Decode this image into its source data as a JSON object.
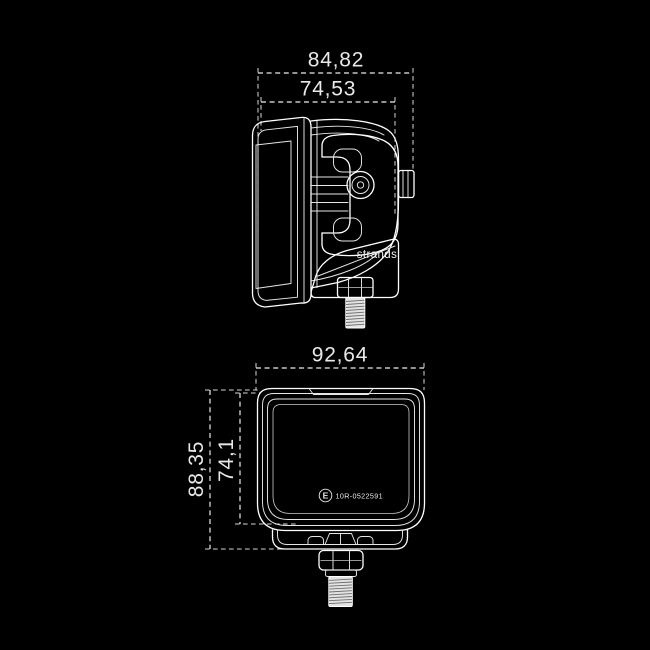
{
  "colors": {
    "background": "#000000",
    "line": "#ffffff",
    "dimension_text": "#e9e9e9"
  },
  "side_view": {
    "dim_outer_width": "84,82",
    "dim_inner_width": "74,53",
    "brand": "strands"
  },
  "rear_view": {
    "dim_width": "92,64",
    "dim_height_outer": "88,35",
    "dim_height_inner": "74,1",
    "approval_letter": "E",
    "approval_number": "10R-0522591"
  }
}
